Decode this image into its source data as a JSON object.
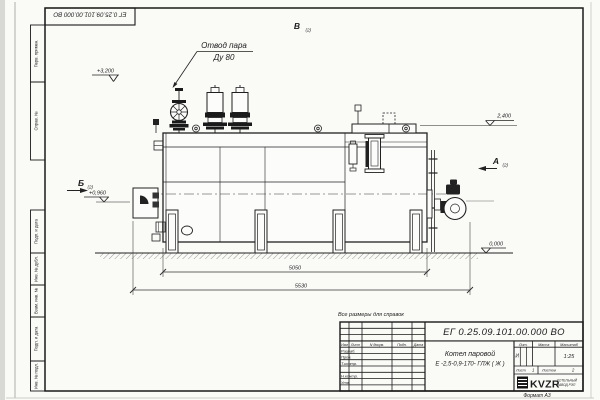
{
  "stamp_top": {
    "doc_number": "ЕГ 0.25.09.101.00.000  ВО"
  },
  "margin": {
    "cell1": "Перв. примен.",
    "cell2": "Справ. №",
    "cell3": "Подп. и дата",
    "cell4": "Инв. № дубл.",
    "cell5": "Взам. инв. №",
    "cell6": "Подп. и дата",
    "cell7": "Инв. № подл."
  },
  "drawing": {
    "callout_line1": "Отвод пара",
    "callout_line2": "Ду 80",
    "elev_3200": "+3,200",
    "elev_2400": "2,400",
    "elev_0960": "+0,960",
    "elev_0000": "0,000",
    "view_v": "В",
    "view_v_sub": "(2)",
    "view_b": "Б",
    "view_b_sub": "(2)",
    "view_a": "А",
    "view_a_sub": "(2)",
    "dim_inner": "5050",
    "dim_overall": "5530",
    "note": "Все размеры для справок"
  },
  "title_block": {
    "doc_number": "ЕГ 0.25.09.101.00.000  ВО",
    "product_line1": "Котел паровой",
    "product_line2": "Е -2,5-0,9-170- ГЛЖ ( Ж )",
    "col_izm": "Изм",
    "col_list": "Лист",
    "col_doc": "N докум.",
    "col_sign": "Подп.",
    "col_date": "Дата",
    "row_razrab": "Разраб.",
    "row_prov": "Пров.",
    "row_tkontr": "Т.контр.",
    "row_nkontr": "Н.контр.",
    "row_utv": "Утв.",
    "lit_header": "Лит.",
    "lit_value": "И",
    "mass_header": "Масса",
    "scale_header": "Масштаб",
    "scale_value": "1:25",
    "sheet_label": "Лист",
    "sheet_value": "1",
    "sheets_label": "Листов",
    "sheets_value": "2",
    "company_logo": "KVZR",
    "company_line1": "КОТЕЛЬНЫЙ",
    "company_line2": "ЗАВОД РЭП",
    "format_note": "Формат А3"
  }
}
